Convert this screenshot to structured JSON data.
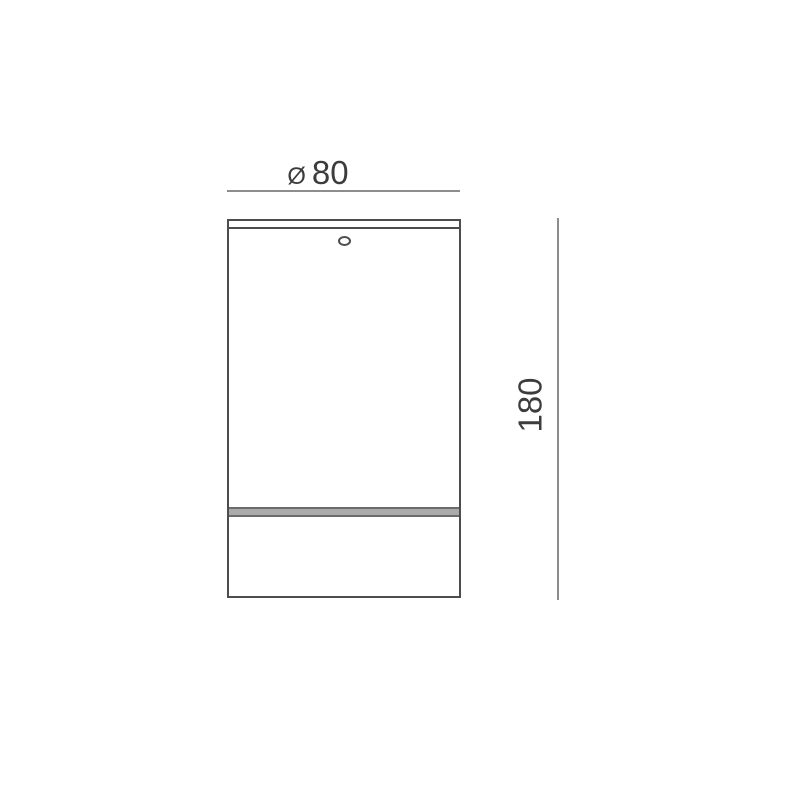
{
  "drawing": {
    "dimensions": {
      "diameter": {
        "symbol": "Ø",
        "value": "80"
      },
      "height": {
        "value": "180"
      }
    },
    "colors": {
      "background": "#ffffff",
      "outline": "#4d4d4d",
      "dim_line": "#8d8d8d",
      "label_text": "#3c3c3c",
      "band_edge": "#6b6b6b",
      "band_fill": "#ababab"
    }
  }
}
